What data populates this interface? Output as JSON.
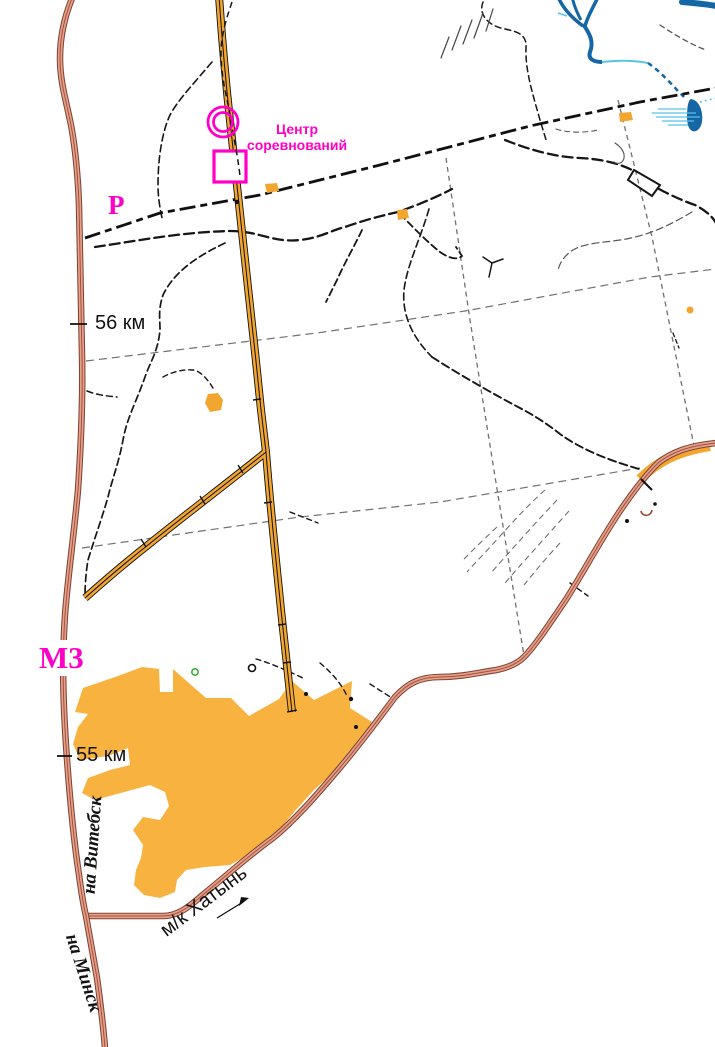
{
  "map": {
    "labels": {
      "competition_center_line1": "Центр",
      "competition_center_line2": "соревнований",
      "road_p": "Р",
      "road_m3": "М3",
      "km_marker_56": "56 км",
      "km_marker_55": "55 км",
      "to_vitebsk": "на Витебск",
      "to_minsk": "на Минск",
      "khatyn_road": "м/к Хатынь"
    },
    "colors": {
      "magenta": "#ff00c8",
      "road_brown_fill": "#e7a18a",
      "road_brown_casing": "#7f4434",
      "road_brown_center": "#9c5240",
      "road_orange": "#f2a62f",
      "field_orange": "#f8b240",
      "water_dark": "#1566a4",
      "water_light": "#57c4e8",
      "grid_gray": "#707070",
      "trail_black": "#161616",
      "label_black": "#121212",
      "spring_brown": "#9c4530",
      "vegetation_green": "#2ab32a"
    },
    "symbols": {
      "competition_center": "magenta-double-circle",
      "start_square": "magenta-square",
      "direction_arrow": "khatyn-direction-arrow"
    }
  }
}
